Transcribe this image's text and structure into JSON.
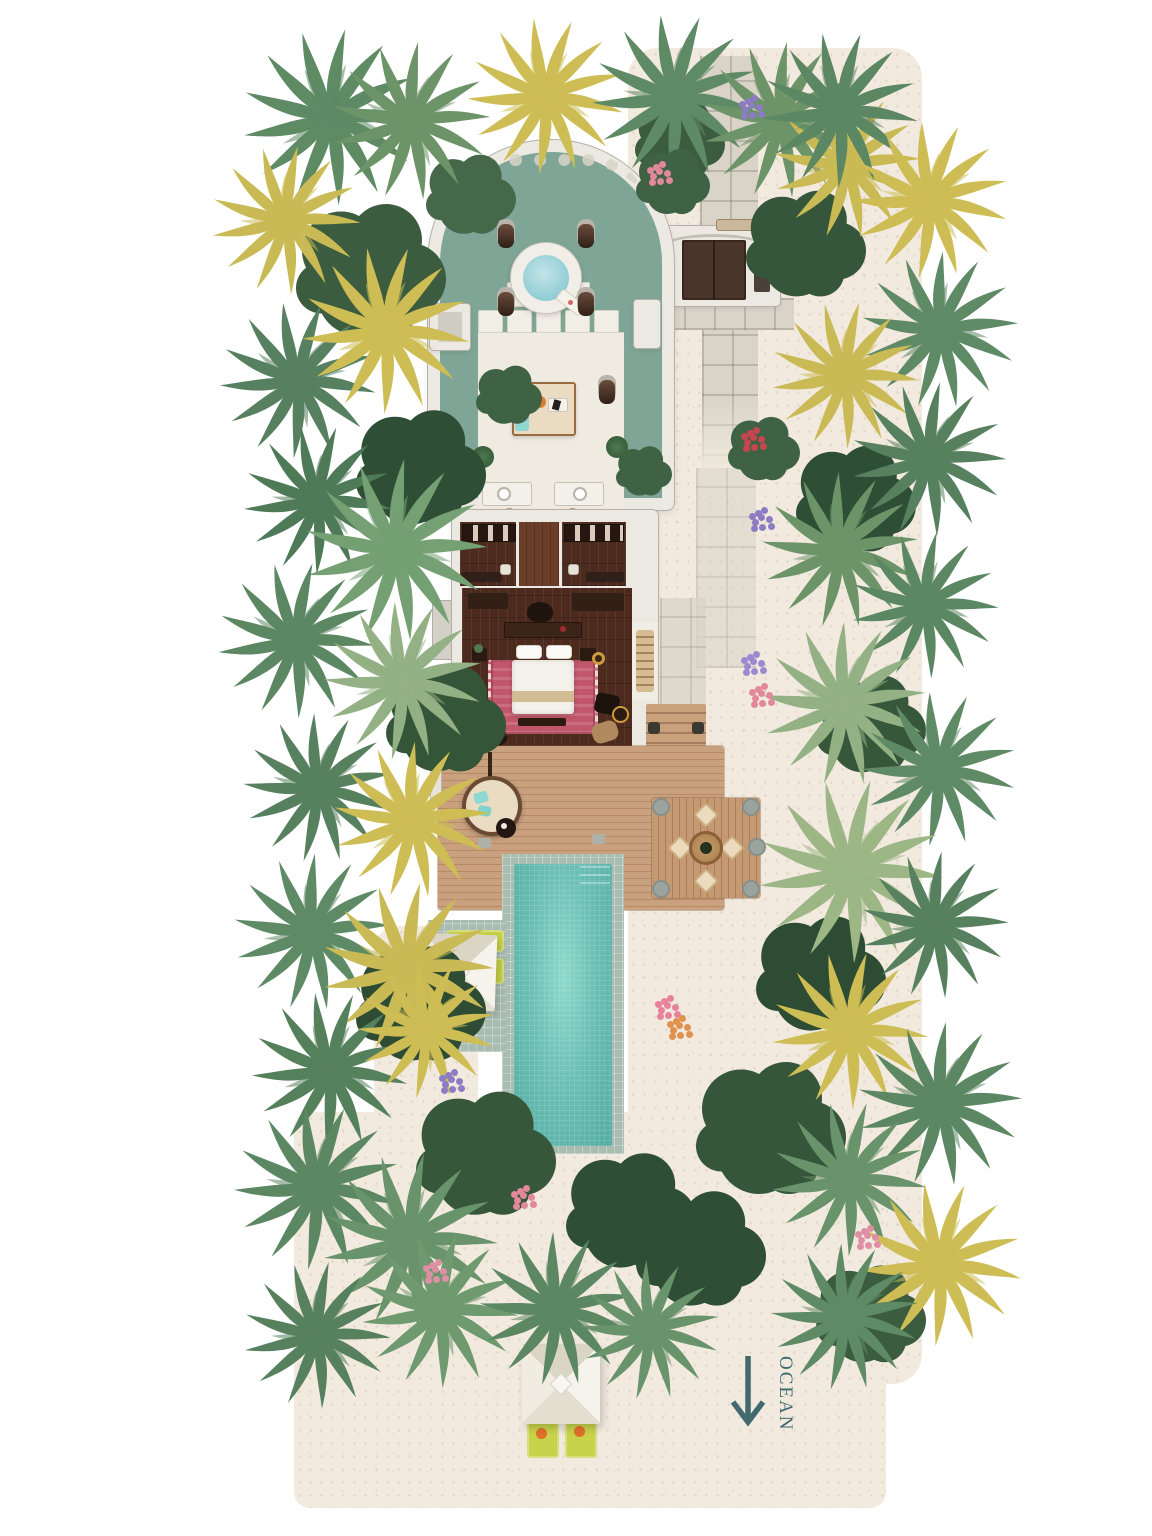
{
  "plan": {
    "ocean": {
      "label": "OCEAN",
      "arrow_direction": "down"
    },
    "palette": {
      "background": "#FFFFFF",
      "sand": "#F2EADF",
      "paver": "#D9D3C8",
      "wall": "#ECE9E2",
      "bath_floor": "#7EA595",
      "tub_water": "#9FD3DA",
      "pool_water": "#63BCB1",
      "pool_tile": "#A9BCB1",
      "deck_wood": "#C49B75",
      "bedroom_wood": "#4C2A1D",
      "rug": "#C2566B",
      "lounger": "#C8D24A",
      "foliage_dark": "#2F4E36",
      "foliage_green": "#5E8A64",
      "foliage_yellow": "#C9BA55",
      "flower_pink": "#E2889B",
      "flower_purple": "#8B7CC4",
      "flower_red": "#C6454E",
      "ocean_text": "#3E6B70"
    },
    "features": [
      "open-air-bathroom",
      "soaking-tub",
      "lounge-daybed",
      "double-vanity",
      "walk-in-closets",
      "bedroom",
      "sun-deck",
      "round-daybed",
      "dining-pavilion",
      "private-pool",
      "pool-loungers",
      "pool-umbrella",
      "entrance-gate",
      "sand-pathway",
      "beach-umbrella",
      "beach-loungers",
      "palm-garden",
      "ocean-direction-arrow"
    ]
  }
}
